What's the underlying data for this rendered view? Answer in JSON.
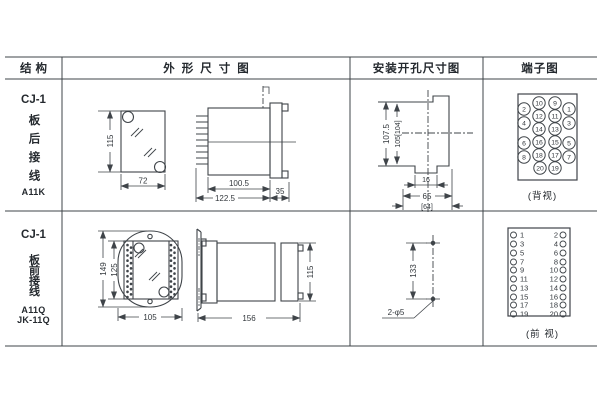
{
  "colors": {
    "line": "#3f4449",
    "text": "#24292e",
    "background": "#ffffff"
  },
  "header": {
    "structure": "结构",
    "outline": "外形尺寸图",
    "mounting": "安装开孔尺寸图",
    "terminal": "端子图"
  },
  "row1": {
    "structure": {
      "model": "CJ-1",
      "wiring_vertical": "板后接线",
      "code": "A11K"
    },
    "outline_dims": {
      "height": "115",
      "width": "72",
      "body_depth": "100.5",
      "total_depth": "122.5",
      "flange_depth": "35"
    },
    "mounting_dims": {
      "outer_height": "107.5",
      "inner_height": "105[104]",
      "notch_width": "16",
      "width": "65",
      "width_alt": "[64]"
    },
    "terminal": {
      "view_label": "(背视)",
      "numbers": [
        "10",
        "9",
        "2",
        "1",
        "12",
        "11",
        "4",
        "3",
        "14",
        "13",
        "6",
        "16",
        "15",
        "5",
        "8",
        "18",
        "17",
        "7",
        "20",
        "19"
      ]
    }
  },
  "row2": {
    "structure": {
      "model": "CJ-1",
      "wiring_vertical": "板前接线",
      "code_line1": "A11Q",
      "code_line2": "JK-11Q"
    },
    "outline_dims": {
      "outer_height": "149",
      "inner_height": "125",
      "width": "105",
      "depth": "156",
      "side_height": "115"
    },
    "mounting_dims": {
      "hole_spacing": "133",
      "hole_spec": "2-φ5"
    },
    "terminal": {
      "view_label": "(前 视)",
      "left": [
        "1",
        "3",
        "5",
        "7",
        "9",
        "11",
        "13",
        "15",
        "17",
        "19"
      ],
      "right": [
        "2",
        "4",
        "6",
        "8",
        "10",
        "12",
        "14",
        "16",
        "18",
        "20"
      ]
    }
  }
}
